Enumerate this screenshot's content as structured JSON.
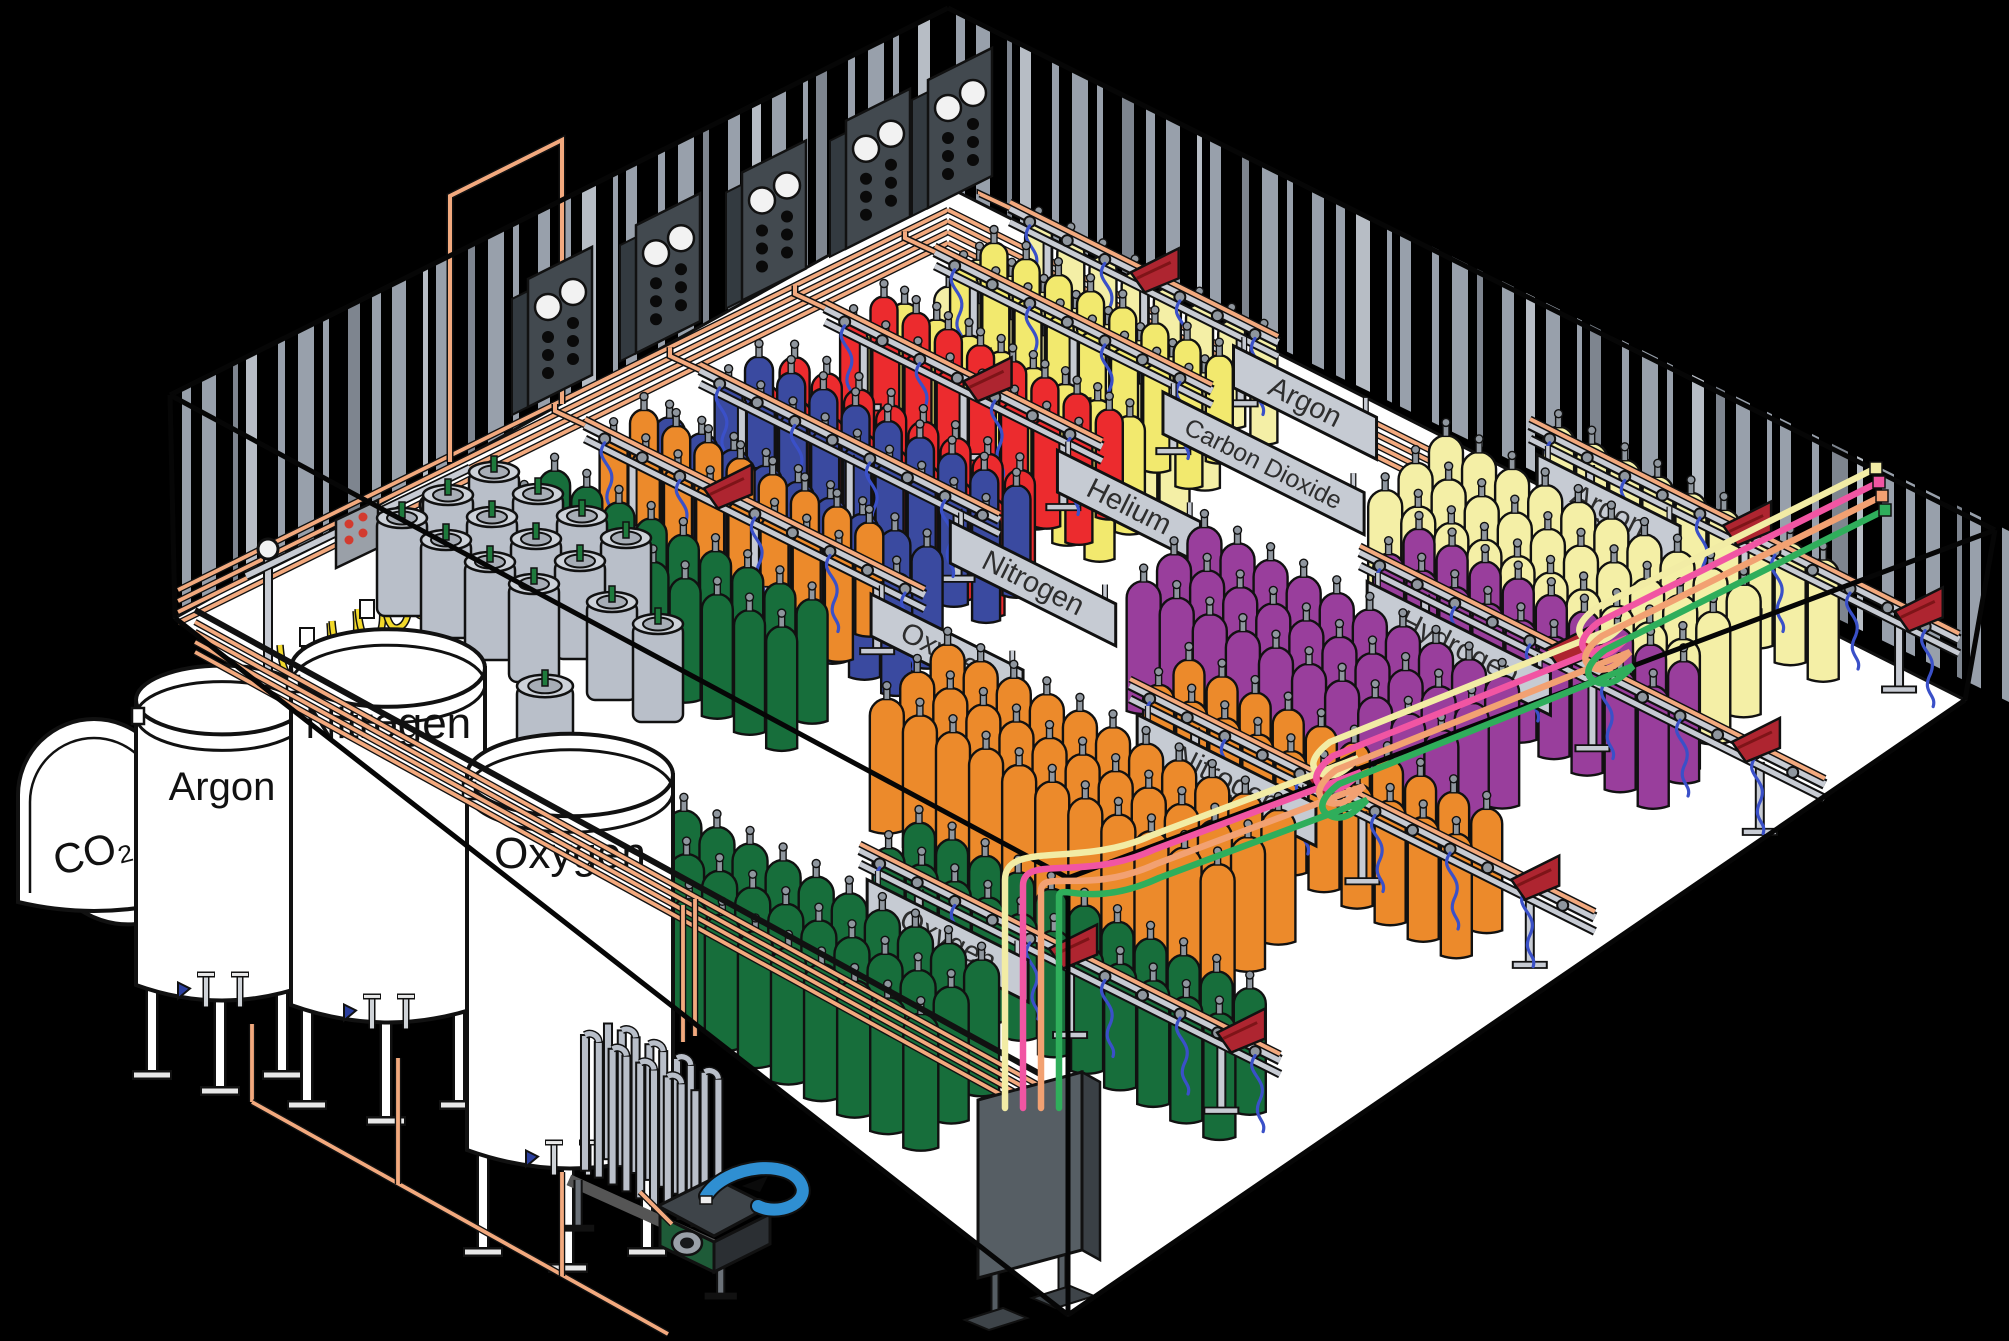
{
  "labels": {
    "tanks": {
      "co2": "CO₂",
      "argon": "Argon",
      "nitrogen": "Nitrogen",
      "oxygen": "Oxygen"
    },
    "back_stations": [
      "Argon",
      "Carbon Dioxide",
      "Helium",
      "Nitrogen",
      "Oxygen"
    ],
    "front_stations": [
      "Argon",
      "Hydrogen",
      "Nitrogen",
      "Oxygen"
    ]
  },
  "colors": {
    "background": "#000000",
    "floor": "#FFFFFF",
    "wallStripe": "#98A0AB",
    "wallStripeLight": "#B7BDC5",
    "wallStripeDark": "#7E858F",
    "copper": "#F2A97E",
    "railGrey": "#C7CBD3",
    "signGrey": "#C6CBD3",
    "signText": "#2E2E2E",
    "panelDark": "#42494F",
    "panelSide": "#333A40",
    "oxygenGreen": "#176E3B",
    "nitrogenOrange": "#EC8A2B",
    "nitrogenBlue": "#3A4AA0",
    "heliumRed": "#EC2B2E",
    "co2Yellow": "#F2E96E",
    "argonPale": "#F4EFA6",
    "hydrogenPurple": "#993E9C",
    "dewarGrey": "#B9BFC9",
    "hoseBlue": "#3A50C8",
    "valveGrey": "#8F969E",
    "trolleyRed": "#AE2530",
    "palletBlue": "#3A4693",
    "pumpGreen": "#1E5B38",
    "pumpBlue": "#2F8FD2",
    "tankWhite": "#FFFFFF",
    "pigtailYellow": "#F2D92B",
    "gaugeRed": "#D23B2F",
    "tubeCream": "#F2ECA5",
    "tubePink": "#F155A3",
    "tubeSalmon": "#F2A172",
    "tubeGreen": "#2FAE5B"
  },
  "tube_colors": [
    "tubeCream",
    "tubePink",
    "tubeSalmon",
    "tubeGreen"
  ],
  "cylinder_colors_back": [
    {
      "front": "argonPale",
      "back": "argonPale"
    },
    {
      "front": "co2Yellow",
      "back": "co2Yellow"
    },
    {
      "front": "heliumRed",
      "back": "heliumRed"
    },
    {
      "front": "nitrogenBlue",
      "back": "nitrogenBlue"
    },
    {
      "front": "oxygenGreen",
      "back": "nitrogenOrange"
    }
  ],
  "cylinder_colors_front": [
    "argonPale",
    "hydrogenPurple",
    "nitrogenOrange",
    "oxygenGreen"
  ]
}
